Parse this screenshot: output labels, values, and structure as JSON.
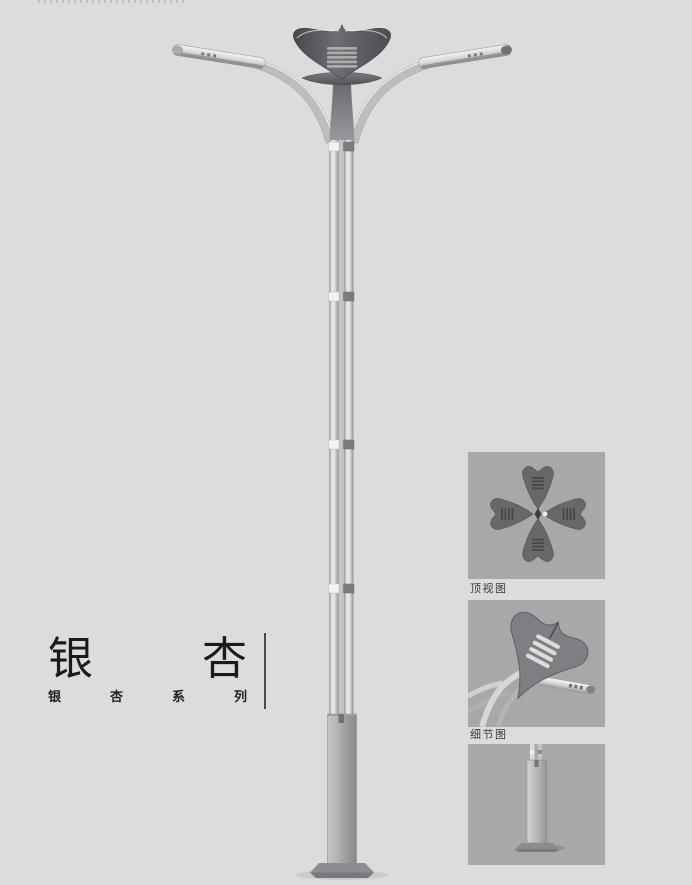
{
  "product": {
    "title": "银杏",
    "title_chars": [
      "银",
      "杏"
    ],
    "series_label": "银杏系列",
    "series_chars": [
      "银",
      "杏",
      "系",
      "列"
    ]
  },
  "figures": {
    "top_view_caption": "顶视图",
    "detail_caption": "细节图",
    "main_illustration": "ginkgo-leaf double-arm street lamp full view",
    "panel_top_view": "four ginkgo-leaf lamp heads arranged in a cross, top view",
    "panel_detail": "ginkgo-leaf crown and lamp arm close-up",
    "panel_base": "square pole base with anchor plate"
  },
  "colors": {
    "page_background": "#dbdcdd",
    "panel_background": "#a7a8a9",
    "title_text": "#1b1b1b",
    "caption_text": "#3a3a3a",
    "divider": "#4a4a4a",
    "crown_metal_dark": "#55575a",
    "pole_metal_light": "#e9eaea",
    "base_metal": "#9b9c9e"
  }
}
